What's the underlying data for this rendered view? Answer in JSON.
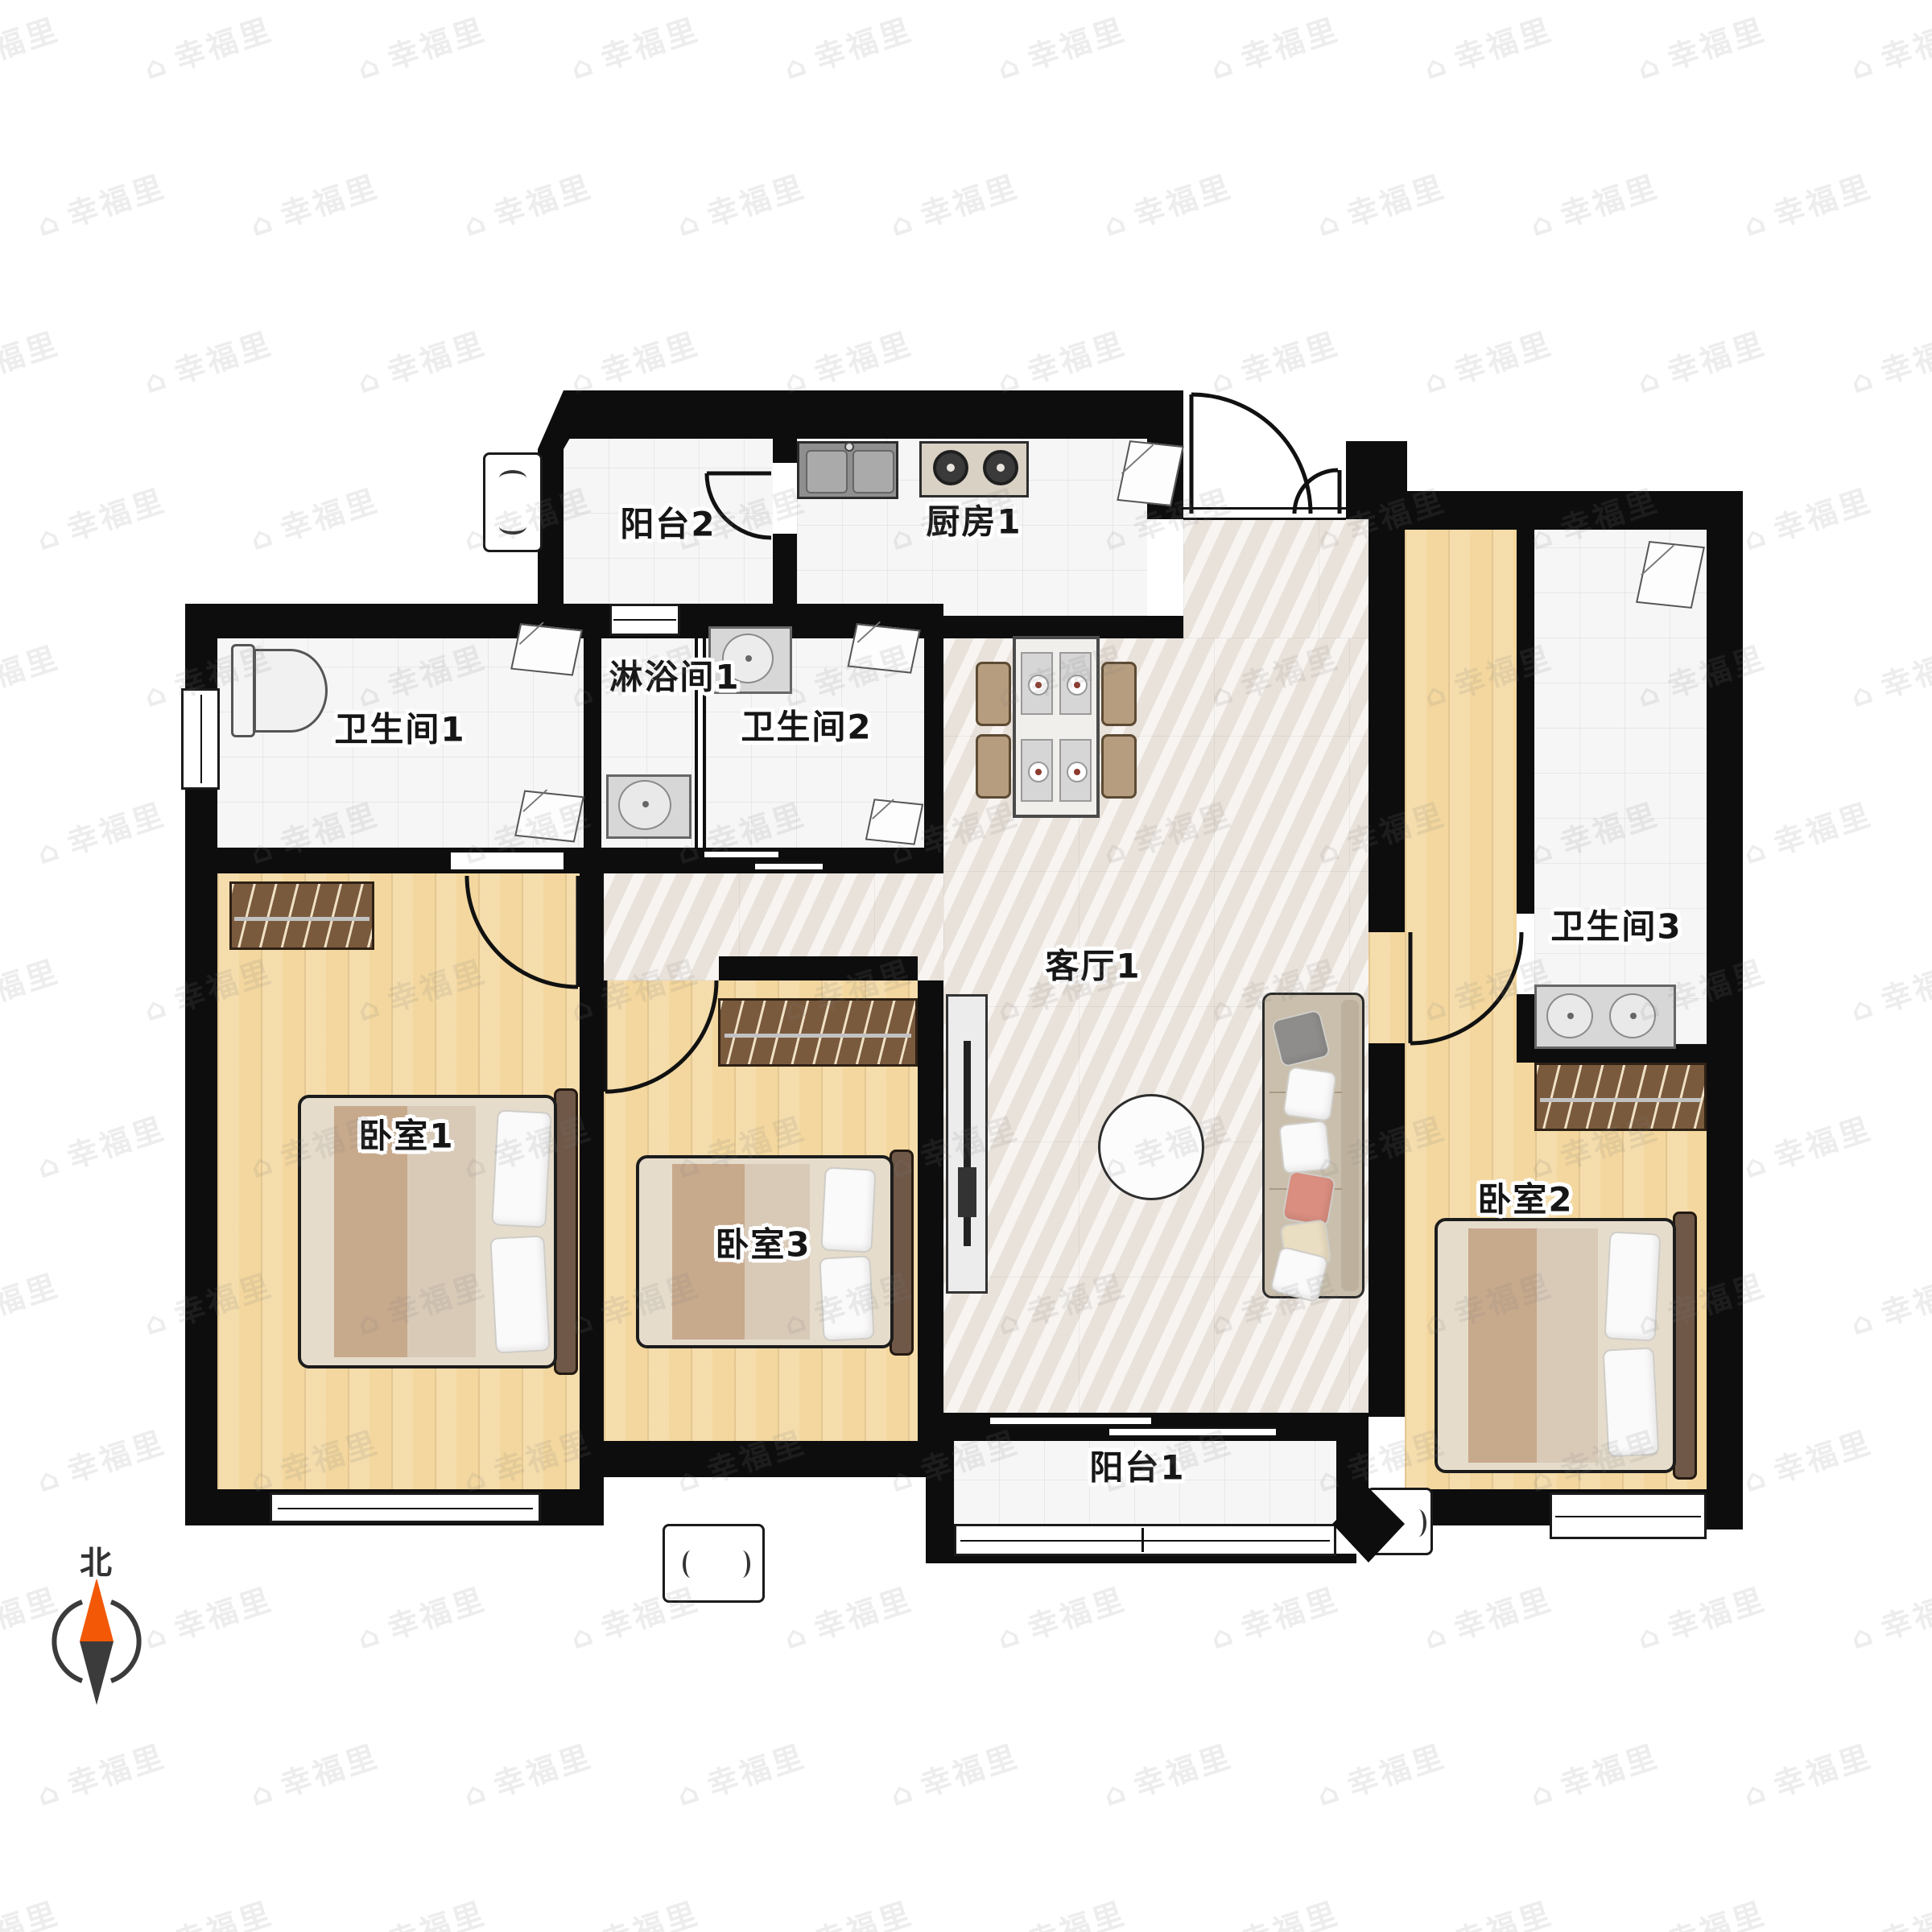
{
  "plan": {
    "title": "apartment-floor-plan",
    "rooms": [
      {
        "id": "balcony-2",
        "label": "阳台2"
      },
      {
        "id": "kitchen-1",
        "label": "厨房1"
      },
      {
        "id": "bathroom-1",
        "label": "卫生间1"
      },
      {
        "id": "shower-1",
        "label": "淋浴间1"
      },
      {
        "id": "bathroom-2",
        "label": "卫生间2"
      },
      {
        "id": "living-1",
        "label": "客厅1"
      },
      {
        "id": "bathroom-3",
        "label": "卫生间3"
      },
      {
        "id": "bedroom-1",
        "label": "卧室1"
      },
      {
        "id": "bedroom-3",
        "label": "卧室3"
      },
      {
        "id": "bedroom-2",
        "label": "卧室2"
      },
      {
        "id": "balcony-1",
        "label": "阳台1"
      }
    ],
    "compass": {
      "label": "北",
      "north_color": "#f25805",
      "south_color": "#3b3b3b"
    },
    "watermark": {
      "text": "幸福里",
      "icon": "house-icon"
    },
    "colors": {
      "wall": "#0d0d0d",
      "wood_floor": "#f3d79e",
      "marble_floor": "#efe9e3",
      "tile_floor": "#f6f6f6",
      "wardrobe": "#7a5a3d",
      "sofa": "#cabfac",
      "bed_blanket_tan": "#c7a98c",
      "headboard": "#6f5847",
      "pillow_red": "#d98e80"
    }
  }
}
